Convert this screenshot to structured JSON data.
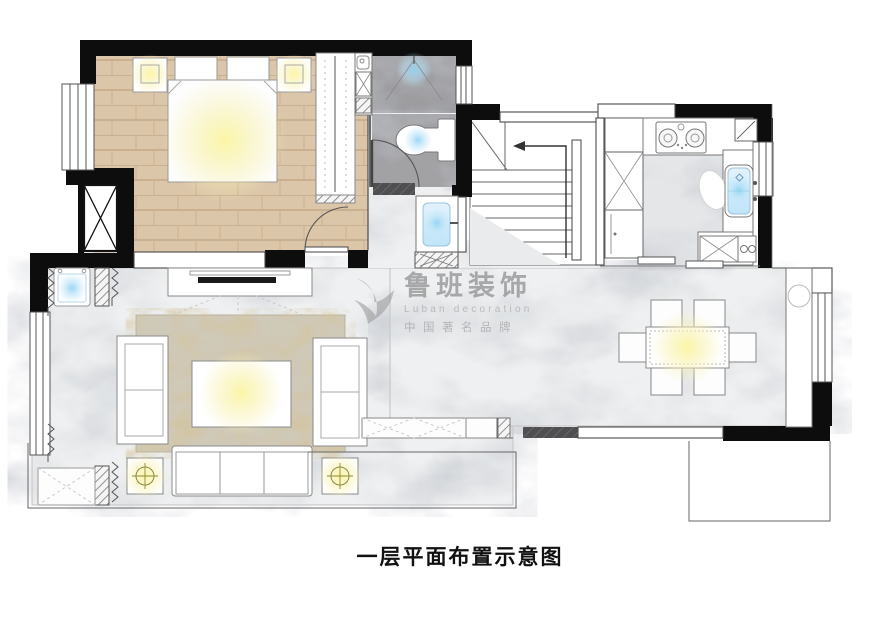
{
  "caption": {
    "text": "一层平面布置示意图"
  },
  "watermark": {
    "brand": "鲁班装饰",
    "tagline_en": "Luban decoration",
    "tagline_cn": "中国著名品牌"
  },
  "palette": {
    "wall_black": "#0d0d0d",
    "wood_floor": "#dcc6a9",
    "marble_floor": "#eef0f1",
    "bath_tile_gray": "#9d9da0",
    "rug_base": "#cfc9b8",
    "rug_gold": "#a98c54",
    "glow_warm": "#f9f3a4",
    "glow_cool": "#a5dbf6",
    "outline_gray": "#4a4a4a",
    "watermark_gray": "#9a9a9a",
    "caption_color": "#111111"
  },
  "fixtures": [
    "bed",
    "pillows",
    "nightstand-lamps",
    "wardrobe",
    "structural-column",
    "shower",
    "toilet",
    "vanity-sink",
    "staircase",
    "stair-direction-arrow",
    "gas-stove",
    "kitchen-sink",
    "refrigerator",
    "sliding-door",
    "dining-table",
    "dining-chairs",
    "pendant-light",
    "sideboard",
    "tv",
    "tv-cabinet",
    "sofa",
    "loveseats",
    "coffee-table",
    "floor-lamps",
    "washing-machine",
    "rug",
    "curtains",
    "windows",
    "low-cabinets"
  ]
}
